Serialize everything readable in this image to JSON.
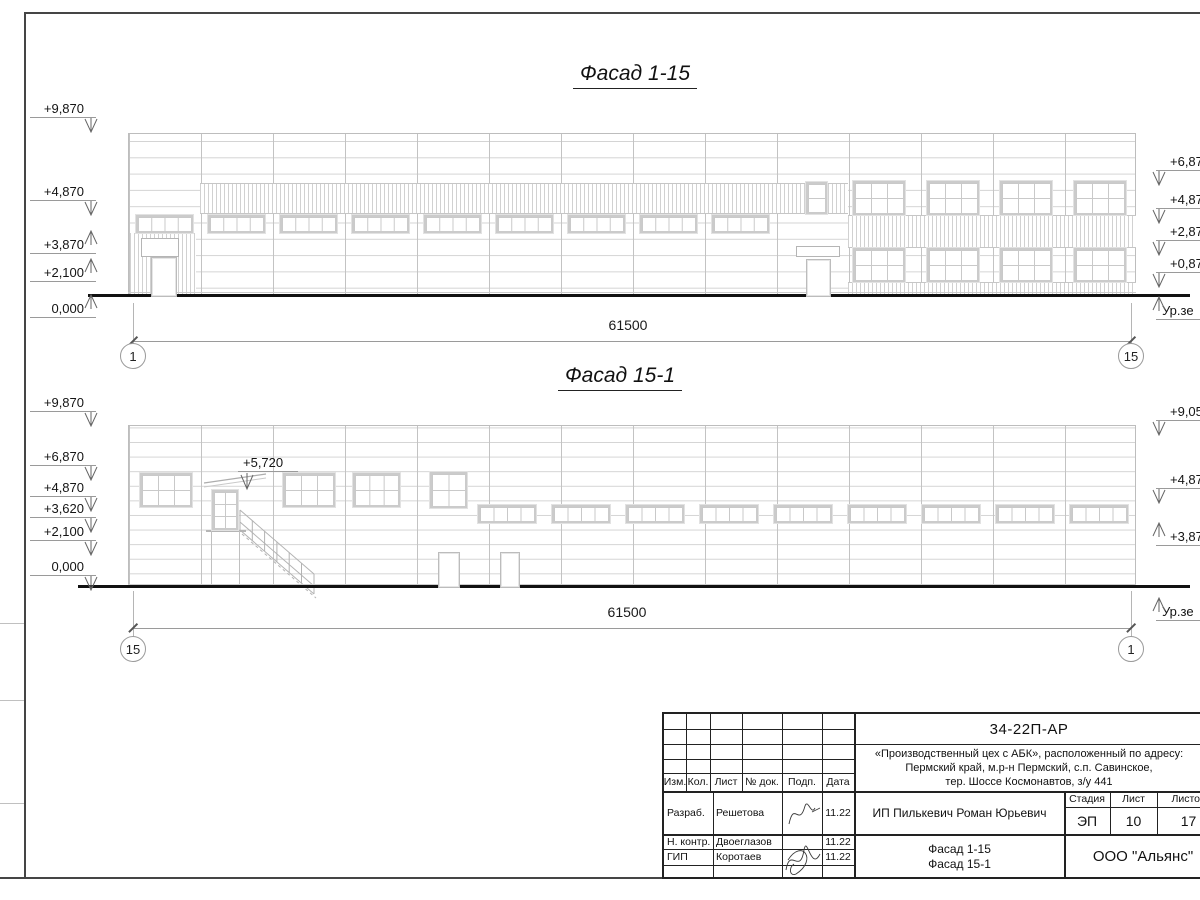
{
  "palette": {
    "line_light": "#c9c9c9",
    "line_medium": "#9a9a9a",
    "line_dark": "#222222",
    "ground": "#111111"
  },
  "facade1": {
    "title": "Фасад 1-15",
    "dimension": "61500",
    "axis_left": "1",
    "axis_right": "15",
    "marks_left": [
      "+9,870",
      "+4,870",
      "+3,870",
      "+2,100",
      "0,000"
    ],
    "marks_right": [
      "+6,87",
      "+4,87",
      "+2,87",
      "+0,87",
      "Ур.зе"
    ]
  },
  "facade2": {
    "title": "Фасад 15-1",
    "dimension": "61500",
    "axis_left": "15",
    "axis_right": "1",
    "mark_extra": "+5,720",
    "marks_left": [
      "+9,870",
      "+6,870",
      "+4,870",
      "+3,620",
      "+2,100",
      "0,000"
    ],
    "marks_right": [
      "+9,05",
      "+4,87",
      "+3,87",
      "Ур.зе"
    ]
  },
  "titleblock": {
    "doc_number": "34-22П-АР",
    "address_lines": [
      "«Производственный цех с АБК», расположенный по адресу:",
      "Пермский край, м.р-н Пермский, с.п. Савинское,",
      "тер. Шоссе Космонавтов, з/у 441"
    ],
    "cols": [
      "Изм.",
      "Кол.",
      "Лист",
      "№ док.",
      "Подп.",
      "Дата"
    ],
    "rows": [
      {
        "role": "Разраб.",
        "name": "Решетова",
        "date": "11.22"
      },
      {
        "role": "Н. контр.",
        "name": "Двоеглазов",
        "date": "11.22"
      },
      {
        "role": "ГИП",
        "name": "Коротаев",
        "date": "11.22"
      }
    ],
    "client": "ИП Пилькевич Роман Юрьевич",
    "stage_label": "Стадия",
    "sheet_label": "Лист",
    "sheets_label": "Листов",
    "stage": "ЭП",
    "sheet": "10",
    "sheets": "17",
    "drawing_title_lines": [
      "Фасад 1-15",
      "Фасад 15-1"
    ],
    "company": "ООО \"Альянс\""
  }
}
